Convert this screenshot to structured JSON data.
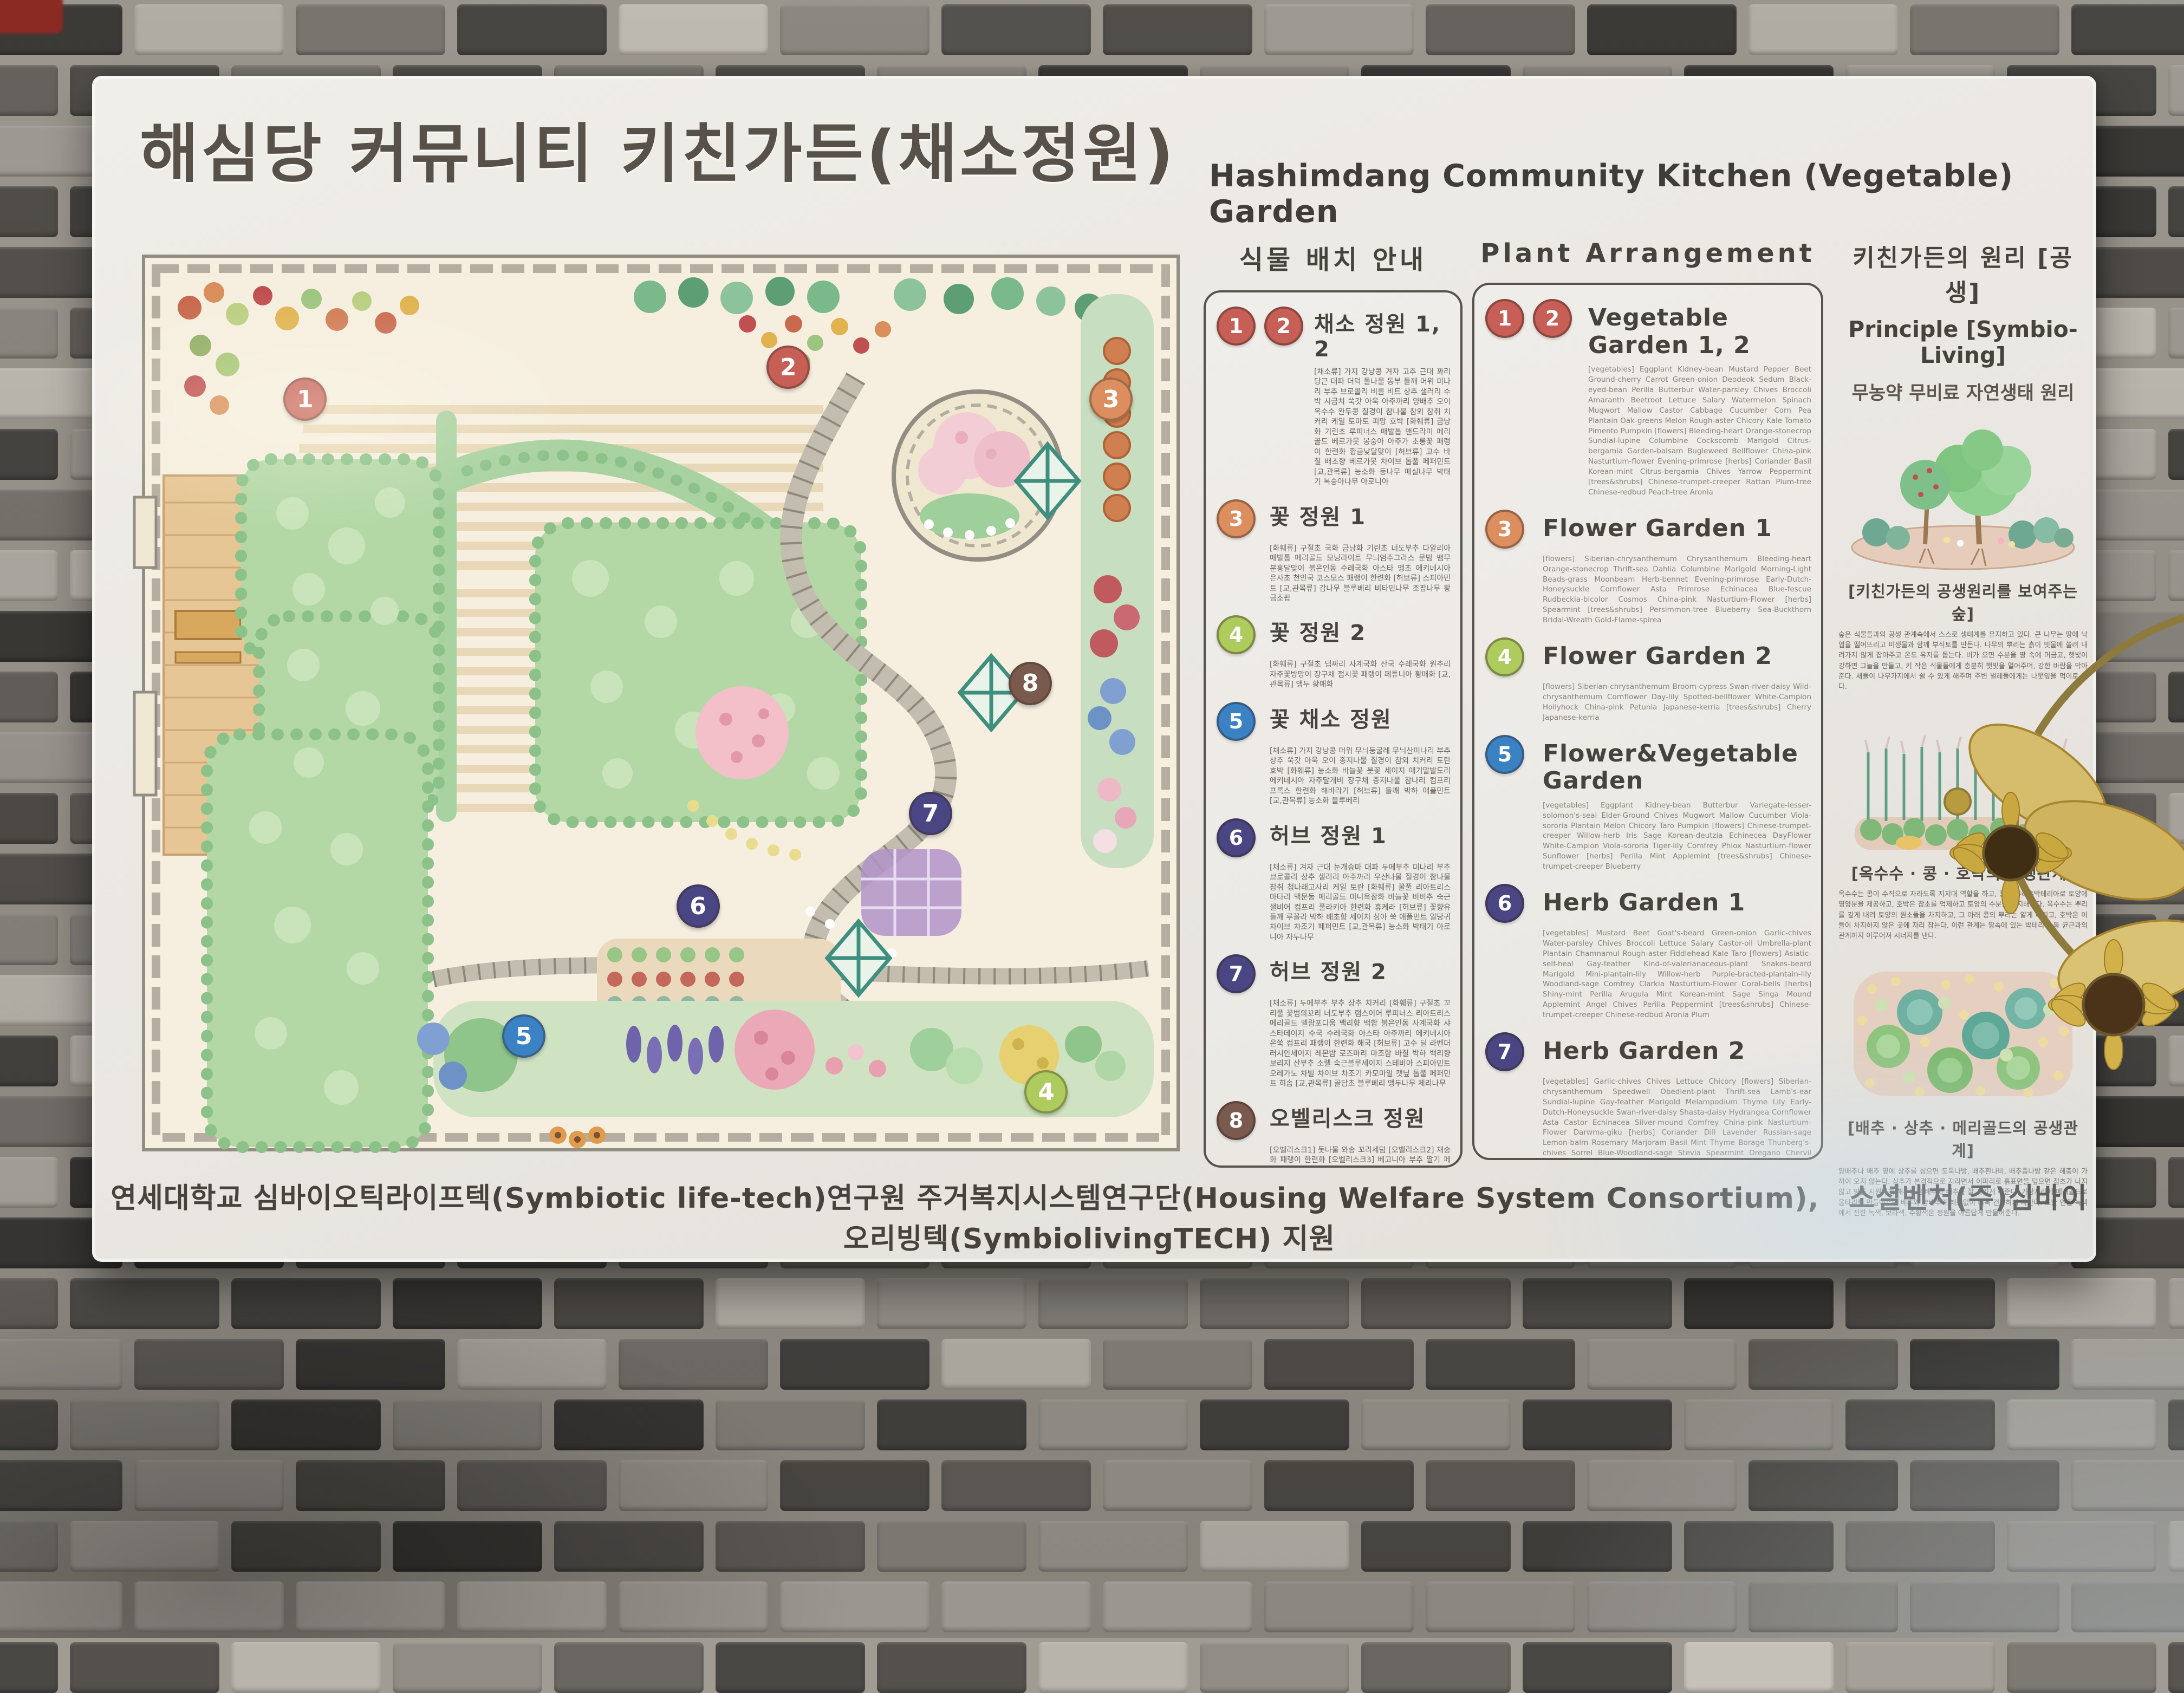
{
  "theme": {
    "sign_bg": "#eae7e2",
    "text_dark": "#46423c",
    "text_light": "#8a847b",
    "badge_red": "#c75f56",
    "badge_orange": "#dd8e5e",
    "badge_green": "#aecb5d",
    "badge_blue": "#3b82c4",
    "badge_indigo": "#4a4583",
    "badge_brown": "#7a5a4d"
  },
  "sign": {
    "title_kr": "해심당 커뮤니티 키친가든(채소정원)",
    "title_en": "Hashimdang Community Kitchen (Vegetable) Garden",
    "footer_left": "연세대학교 심바이오틱라이프텍(Symbiotic life-tech)연구원 주거복지시스템연구단(Housing Welfare System Consortium),",
    "footer_right": "소셜벤처(주)심바이오리빙텍(SymbiolivingTECH) 지원"
  },
  "map": {
    "markers": [
      {
        "n": "1",
        "x": 16.5,
        "y": 17.1,
        "color": "#c75f56",
        "label_kr": "채소 정원 1",
        "label_en": "Vegetable Garden 1"
      },
      {
        "n": "2",
        "x": 62.0,
        "y": 13.6,
        "color": "#c75f56",
        "label_kr": "채소 정원 2",
        "label_en": "Vegetable Garden 2"
      },
      {
        "n": "3",
        "x": 92.4,
        "y": 17.1,
        "color": "#dd8e5e",
        "label_kr": "꽃 정원 1",
        "label_en": "Flower Garden 1"
      },
      {
        "n": "4",
        "x": 86.3,
        "y": 92.7,
        "color": "#aecb5d",
        "label_kr": "꽃 정원 2",
        "label_en": "Flower Garden 2"
      },
      {
        "n": "5",
        "x": 37.1,
        "y": 86.6,
        "color": "#3b82c4",
        "label_kr": "꽃 채소 정원",
        "label_en": "Flower&Vegetable Garden"
      },
      {
        "n": "6",
        "x": 53.5,
        "y": 72.4,
        "color": "#4a4583",
        "label_kr": "허브 정원 1",
        "label_en": "Herb Garden 1"
      },
      {
        "n": "7",
        "x": 75.4,
        "y": 62.3,
        "color": "#4a4583",
        "label_kr": "허브 정원 2",
        "label_en": "Herb Garden 2"
      },
      {
        "n": "8",
        "x": 84.8,
        "y": 48.1,
        "color": "#7a5a4d",
        "label_kr": "오벨리스크 정원",
        "label_en": "Obelisk Garden"
      }
    ]
  },
  "lists": {
    "kr": {
      "header": "식물 배치 안내",
      "items": [
        {
          "nums": [
            "1",
            "2"
          ],
          "title": "채소 정원 1, 2",
          "desc": "[채소류] 가지 강낭콩 겨자 고추 근대 꽈리 당근 대파 더덕 돌나물 동부 들깨 머위 미나리 부추 브로콜리 비름 비트 상추 샐러리 수박 시금치 쑥갓 아욱 아주까리 양배추 오이 옥수수 완두콩 질경이 참나물 참외 참취 치커리 케일 토마토 피망 호박 [화훼류] 금낭화 기린초 루피너스 매발톱 맨드라미 메리골드 베르가못 봉숭아 아주가 초롱꽃 패랭이 한련화 황금낮달맞이 [허브류] 고수 바질 배초향 베르가못 차이브 톱풀 페퍼민트 [교,관목류] 능소화 등나무 매실나무 박태기 복숭아나무 아로니아"
        },
        {
          "nums": [
            "3"
          ],
          "title": "꽃 정원 1",
          "desc": "[화훼류] 구절초 국화 금낭화 기린초 너도부추 다알리아 매발톱 메리골드 모닝라이트 무늬엄주그라스 문빔 뱀무 분홍달맞이 붉은인동 수레국화 아스타 앵초 에키네시아 은사초 천인국 코스모스 패랭이 한련화 [허브류] 스피아민트 [교,관목류] 감나무 블루베리 비타민나무 조팝나무 황금조팝"
        },
        {
          "nums": [
            "4"
          ],
          "title": "꽃 정원 2",
          "desc": "[화훼류] 구절초 댑싸리 사계국화 산국 수레국화 원추리 자주꽃방망이 장구채 접시꽃 패랭이 페튜니아 황매화 [교,관목류] 앵두 황매화"
        },
        {
          "nums": [
            "5"
          ],
          "title": "꽃 채소 정원",
          "desc": "[채소류] 가지 강낭콩 머위 무늬둥굴레 무늬산미나리 부추 상추 쑥갓 아욱 오이 종지나물 질경이 참외 치커리 토란 호박 [화훼류] 능소화 바늘꽃 붓꽃 세이지 애기말발도리 에키네시아 자주달개비 장구채 종지나물 참나리 컴프리 프록스 한련화 해바라기 [허브류] 들깨 박하 애플민트 [교,관목류] 능소화 블루베리"
        },
        {
          "nums": [
            "6"
          ],
          "title": "허브 정원 1",
          "desc": "[채소류] 겨자 근대 눈개승마 대파 두메부추 미나리 부추 브로콜리 상추 샐러리 아주까리 우산나물 질경이 참나물 참취 청나래고사리 케일 토란 [화훼류] 꿀풀 리아트리스 마타리 맥문동 메리골드 미니옥잠화 바늘꽃 비비추 숙근샐비어 컴프리 풀라키아 한련화 휴케라 [허브류] 꽃향유 들깨 루꼴라 박하 배초향 세이지 싱아 쑥 애플민트 일당귀 차이브 차조기 페퍼민트 [교,관목류] 능소화 박태기 아로니아 자두나무"
        },
        {
          "nums": [
            "7"
          ],
          "title": "허브 정원 2",
          "desc": "[채소류] 두메부추 부추 상추 치커리 [화훼류] 구절초 꼬리풀 꽃범의꼬리 너도부추 램스이어 루피너스 리아트리스 메리골드 멜람포디움 백리향 백합 붉은인동 사계국화 샤스타데이지 수국 수레국화 아스타 아주까리 에키네시아 은쑥 컴프리 패랭이 한련화 해국 [허브류] 고수 딜 라벤더 러시안세이지 레몬밤 로즈마리 마조람 바질 박하 백리향 보리지 산부추 소렐 숙근블루세이지 스테비아 스피아민트 오레가노 차빌 차이브 차조기 카모마일 캣닢 톱풀 페퍼민트 히솝 [교,관목류] 골담초 블루베리 앵두나무 체리나무"
        },
        {
          "nums": [
            "8"
          ],
          "title": "오벨리스크 정원",
          "desc": "[오벨리스크1] 돗나물 와송 꼬리세덤 [오벨리스크2] 채송화 패랭이 한련화 [오벨리스크3] 베고니아 부추 딸기 페츄니아"
        }
      ]
    },
    "en": {
      "header": "Plant Arrangement",
      "items": [
        {
          "nums": [
            "1",
            "2"
          ],
          "title": "Vegetable Garden 1, 2",
          "desc": "[vegetables] Eggplant Kidney-bean Mustard Pepper Beet Ground-cherry Carrot Green-onion Deodeok Sedum Black-eyed-bean Perilla Butterbur Water-parsley Chives Broccoli Amaranth Beetroot Lettuce Salary Watermelon Spinach Mugwort Mallow Castor Cabbage Cucumber Corn Pea Plantain Oak-greens Melon Rough-aster Chicory Kale Tomato Pimento Pumpkin [flowers] Bleeding-heart Orange-stonecrop Sundial-lupine Columbine Cockscomb Marigold Citrus-bergamia Garden-balsam Bugleweed Bellflower China-pink Nasturtium-flower Evening-primrose [herbs] Coriander Basil Korean-mint Citrus-bergamia Chives Yarrow Peppermint [trees&shrubs] Chinese-trumpet-creeper Rattan Plum-tree Chinese-redbud Peach-tree Aronia"
        },
        {
          "nums": [
            "3"
          ],
          "title": "Flower Garden 1",
          "desc": "[flowers] Siberian-chrysanthemum Chrysanthemum Bleeding-heart Orange-stonecrop Thrift-sea Dahlia Columbine Marigold Morning-Light Beads-grass Moonbeam Herb-bennet Evening-primrose Early-Dutch-Honeysuckle Cornflower Asta Primrose Echinacea Blue-fescue Rudbeckia-bicolor Cosmos China-pink Nasturtium-Flower [herbs] Spearmint [trees&shrubs] Persimmon-tree Blueberry Sea-Buckthorn Bridal-Wreath Gold-Flame-spirea"
        },
        {
          "nums": [
            "4"
          ],
          "title": "Flower Garden 2",
          "desc": "[flowers] Siberian-chrysanthemum Broom-cypress Swan-river-daisy Wild-chrysanthemum Cornflower Day-lily Spotted-bellflower White-Campion Hollyhock China-pink Petunia Japanese-kerria [trees&shrubs] Cherry Japanese-kerria"
        },
        {
          "nums": [
            "5"
          ],
          "title": "Flower&Vegetable Garden",
          "desc": "[vegetables] Eggplant Kidney-bean Butterbur Variegate-lesser-solomon's-seal Elder-Ground Chives Mugwort Mallow Cucumber Viola-sororia Plantain Melon Chicory Taro Pumpkin [flowers] Chinese-trumpet-creeper Willow-herb Iris Sage Korean-deutzia Echinecea DayFlower White-Campion Viola-sororia Tiger-lily Comfrey Phlox Nasturtium-flower Sunflower [herbs] Perilla Mint Applemint [trees&shrubs] Chinese-trumpet-creeper Blueberry"
        },
        {
          "nums": [
            "6"
          ],
          "title": "Herb Garden 1",
          "desc": "[vegetables] Mustard Beet Goat's-beard Green-onion Garlic-chives Water-parsley Chives Broccoli Lettuce Salary Castor-oil Umbrella-plant Plantain Chamnamul Rough-aster Fiddlehead Kale Taro [flowers] Asiatic-self-heal Gay-feather Kind-of-valerianaceous-plant Snakes-beard Marigold Mini-plantain-lily Willow-herb Purple-bracted-plantain-lily Woodland-sage Comfrey Clarkia Nasturtium-Flower Coral-bells [herbs] Shiny-mint Perilla Arugula Mint Korean-mint Sage Singa Mound Applemint Angel Chives Perilla Peppermint [trees&shrubs] Chinese-trumpet-creeper Chinese-redbud Aronia Plum"
        },
        {
          "nums": [
            "7"
          ],
          "title": "Herb Garden 2",
          "desc": "[vegetables] Garlic-chives Chives Lettuce Chicory [flowers] Siberian-chrysanthemum Speedwell Obedient-plant Thrift-sea Lamb's-ear Sundial-lupine Gay-feather Marigold Melampodium Thyme Lily Early-Dutch-Honeysuckle Swan-river-daisy Shasta-daisy Hydrangea Cornflower Asta Castor Echinacea Silver-mound Comfrey China-pink Nasturtium-Flower Darwma-giku [herbs] Coriander Dill Lavender Russian-sage Lemon-balm Rosemary Marjoram Basil Mint Thyme Borage Thunberg's-chives Sorrel Blue-Woodland-sage Stevia Spearmint Oregano Chervil Chives Beefsteak-plant Chamomile Catnip Yarrow Peppermint Hyssop [trees&shrubs] Caragana-root Blueberry Korean-cherry-tree Cherry-tree"
        },
        {
          "nums": [
            "8"
          ],
          "title": "Obelisk Garden",
          "desc": "[Obelisk 1] Tall-sedum Sedum Wasong [Obelisk 2] Rose-moss China-pink Nasturtium-Flower [Obelisk 3] Strawberry Begonia Chives Petunia"
        }
      ]
    }
  },
  "principle": {
    "title_kr": "키친가든의 원리 [공생]",
    "title_en": "Principle [Symbio-Living]",
    "subtitle": "무농약 무비료 자연생태 원리",
    "sections": [
      {
        "caption": "[키친가든의 공생원리를 보여주는 숲]",
        "desc": "숲은 식물들과의 공생 관계속에서 스스로 생태계를 유지하고 있다. 큰 나무는 땅에 낙엽을 떨어뜨리고 미생물과 함께 부식토를 만든다. 나무의 뿌리는 흙이 빗물에 쓸려 내려가지 않게 잡아주고 온도 유지를 돕는다. 비가 오면 수분을 땅 속에 머금고, 햇빛이 강하면 그늘을 만들고, 키 작은 식물들에게 충분히 햇빛을 열어주며, 강한 바람을 막아준다. 새들이 나무가지에서 쉴 수 있게 해주며 주변 벌레들에게는 나뭇잎을 먹이로 준다."
      },
      {
        "caption": "[옥수수 · 콩 · 호박의 공생관계]",
        "desc": "옥수수는 콩이 수직으로 자라도록 지지대 역할을 하고, 콩은 뿌리혹박테리아로 토양에 영양분을 제공하고, 호박은 잡초를 억제하고 토양의 수분을 유지해준다. 옥수수는 뿌리를 깊게 내려 토양의 원소들을 차지하고, 그 아래 콩의 뿌리는 얕게 내리고, 호박은 이들이 차지하지 않은 곳에 자리 잡는다. 이런 관계는 땅속에 있는 박테리아 등 균근과의 관계까지 이루어져 시너지를 낸다."
      },
      {
        "caption": "[배추 · 상추 · 메리골드의 공생관계]",
        "desc": "양배추나 배추 옆에 상추를 심으면 도둑나방, 배추흰나비, 배추좀나방 같은 해충이 가까이 오지 않는다. 상추가 본격적으로 자라면서 이파리로 흙표면을 덮으면 잡초가 나지 않고 땅을 시원하게 해주어 양배추와 배추를 잘 자라게 해준다. 가장자리에 메리골드로 울타리를 만들어주면 배추와 양배추가 해충없이 더욱 건강하게 자란다. 또한 연한 녹색에서 진한 녹색, 보라색, 주황색은 정원을 아름답게 만들어준다."
      }
    ]
  }
}
